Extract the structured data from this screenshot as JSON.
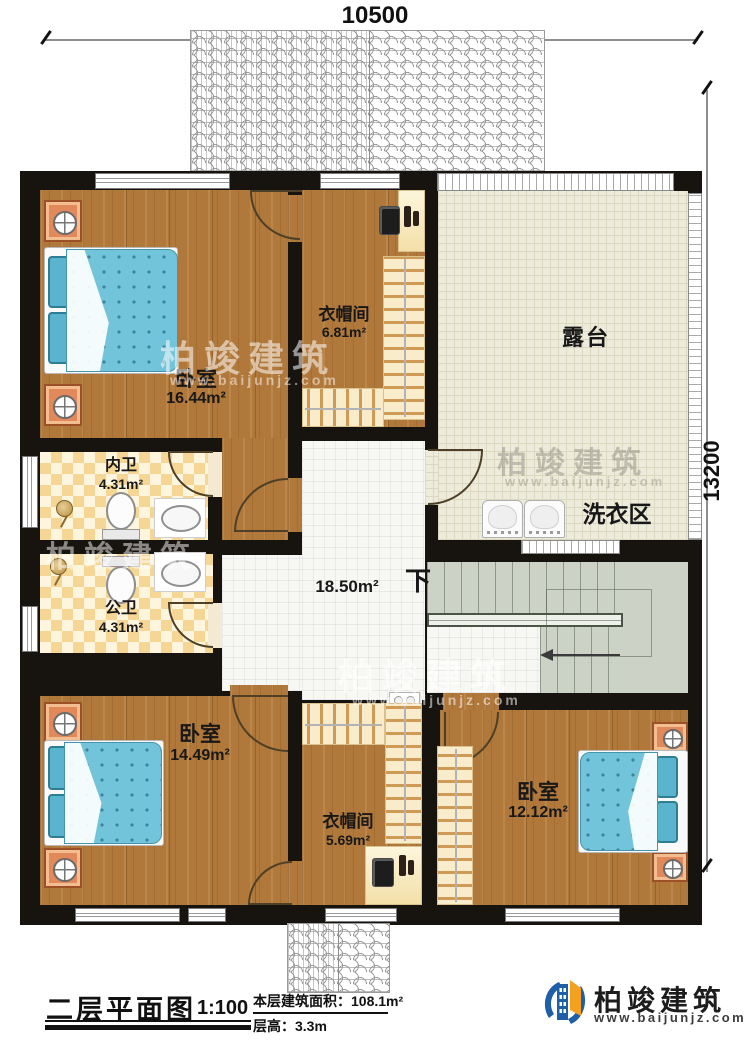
{
  "dimensions": {
    "top": "10500",
    "right": "13200"
  },
  "rooms": {
    "bedroom1": {
      "name": "卧室",
      "area": "16.44m²"
    },
    "cloakroom1": {
      "name": "衣帽间",
      "area": "6.81m²"
    },
    "terrace": {
      "name": "露台"
    },
    "laundry": {
      "name": "洗衣区"
    },
    "bath_inner": {
      "name": "内卫",
      "area": "4.31m²"
    },
    "bath_public": {
      "name": "公卫",
      "area": "4.31m²"
    },
    "hall": {
      "area": "18.50m²",
      "down_label": "下"
    },
    "bedroom2": {
      "name": "卧室",
      "area": "14.49m²"
    },
    "cloakroom2": {
      "name": "衣帽间",
      "area": "5.69m²"
    },
    "bedroom3": {
      "name": "卧室",
      "area": "12.12m²"
    }
  },
  "title_block": {
    "title": "二层平面图",
    "scale": "1:100",
    "floor_area": "本层建筑面积：108.1m²",
    "floor_height": "层高：3.3m"
  },
  "branding": {
    "company": "柏竣建筑",
    "website": "www.baijunjz.com"
  },
  "watermark": {
    "text": "柏竣建筑",
    "url": "www.baijunjz.com"
  },
  "colors": {
    "wall": "#17130e",
    "wood": "#b0783a",
    "terrace_tile": "#edebdc",
    "bath_tile_a": "#f5d694",
    "bath_tile_b": "#fdf5dd",
    "hall_tile": "#f7f7f4",
    "stairs": "#ccd3c6",
    "bed": "#72c4da",
    "nightstand": "#e1895b",
    "logo_blue": "#1e5fa8",
    "logo_orange": "#f5a11d"
  }
}
